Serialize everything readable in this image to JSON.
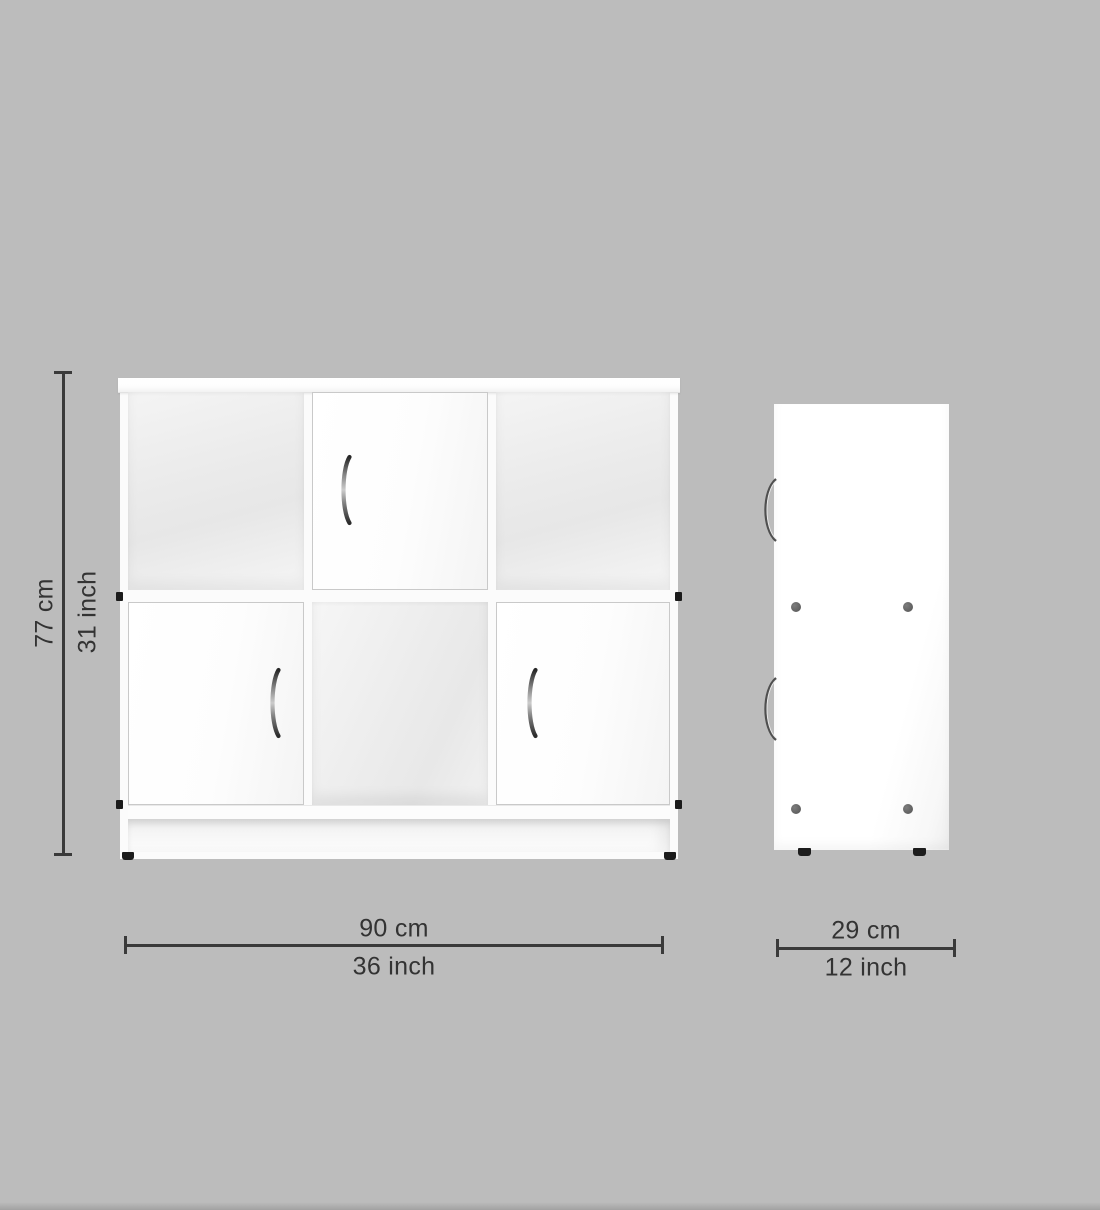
{
  "view_type": "furniture-dimension-diagram",
  "labels": {
    "height_cm": "77 cm",
    "height_inch": "31 inch",
    "width_cm": "90 cm",
    "width_inch": "36 inch",
    "depth_cm": "29 cm",
    "depth_inch": "12 inch"
  },
  "colors": {
    "background": "#bcbcbc",
    "dimension_line": "#3a3a3a",
    "dimension_text": "#333333",
    "cabinet_body": "#ffffff",
    "cube_interior": "#e9e9e9",
    "door_border": "#c9c9c9",
    "handle_metal": "#8f8f8f",
    "screw_dot": "#696969",
    "foot": "#1c1c1c"
  }
}
